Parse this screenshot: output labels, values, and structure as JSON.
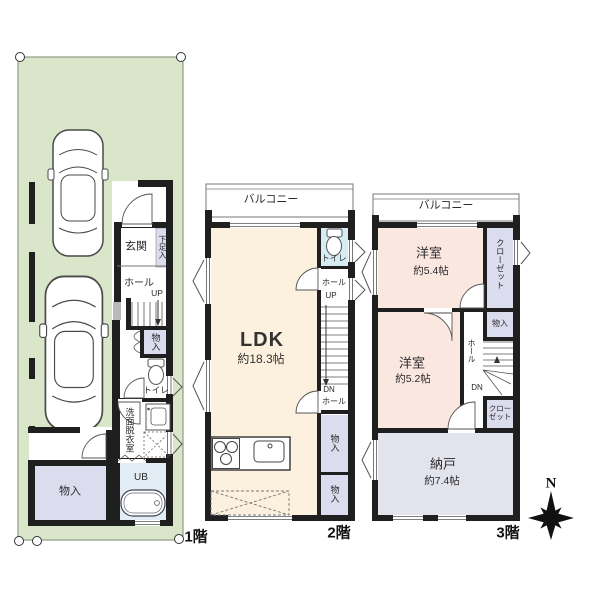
{
  "floors": {
    "f1": {
      "label": "1階",
      "rooms": {
        "genkan": "玄関",
        "shoe_storage": "下足入",
        "hall": "ホール",
        "up": "UP",
        "storage_hall": "物入",
        "toilet": "トイレ",
        "washroom": "洗面脱衣室",
        "bath": "UB",
        "storage": "物入"
      }
    },
    "f2": {
      "label": "2階",
      "balcony": "バルコニー",
      "rooms": {
        "toilet": "トイレ",
        "hall_upper": "ホール",
        "up": "UP",
        "ldk": "LDK",
        "ldk_size": "約18.3帖",
        "dn": "DN",
        "hall_lower": "ホール",
        "storage_a": "物入",
        "storage_b": "物入"
      }
    },
    "f3": {
      "label": "3階",
      "balcony": "バルコニー",
      "rooms": {
        "bedroom_a": "洋室",
        "bedroom_a_size": "約5.4帖",
        "closet_a": "クローゼット",
        "storage": "物入",
        "bedroom_b": "洋室",
        "bedroom_b_size": "約5.2帖",
        "hall": "ホール",
        "dn": "DN",
        "closet_b": "クローゼット",
        "nando": "納戸",
        "nando_size": "約7.4帖"
      }
    }
  },
  "compass": {
    "north_label": "N"
  },
  "colors": {
    "plot_green": "#d9e6c9",
    "ldk_cream": "#fcf1df",
    "bedroom_pink": "#fae7e0",
    "closet_lavender": "#dcdcef",
    "toilet_blue": "#d7ebf3",
    "bath_blue": "#e2ecf4",
    "nando_lavender": "#e3e3ee",
    "wall_black": "#1f1f1f"
  }
}
